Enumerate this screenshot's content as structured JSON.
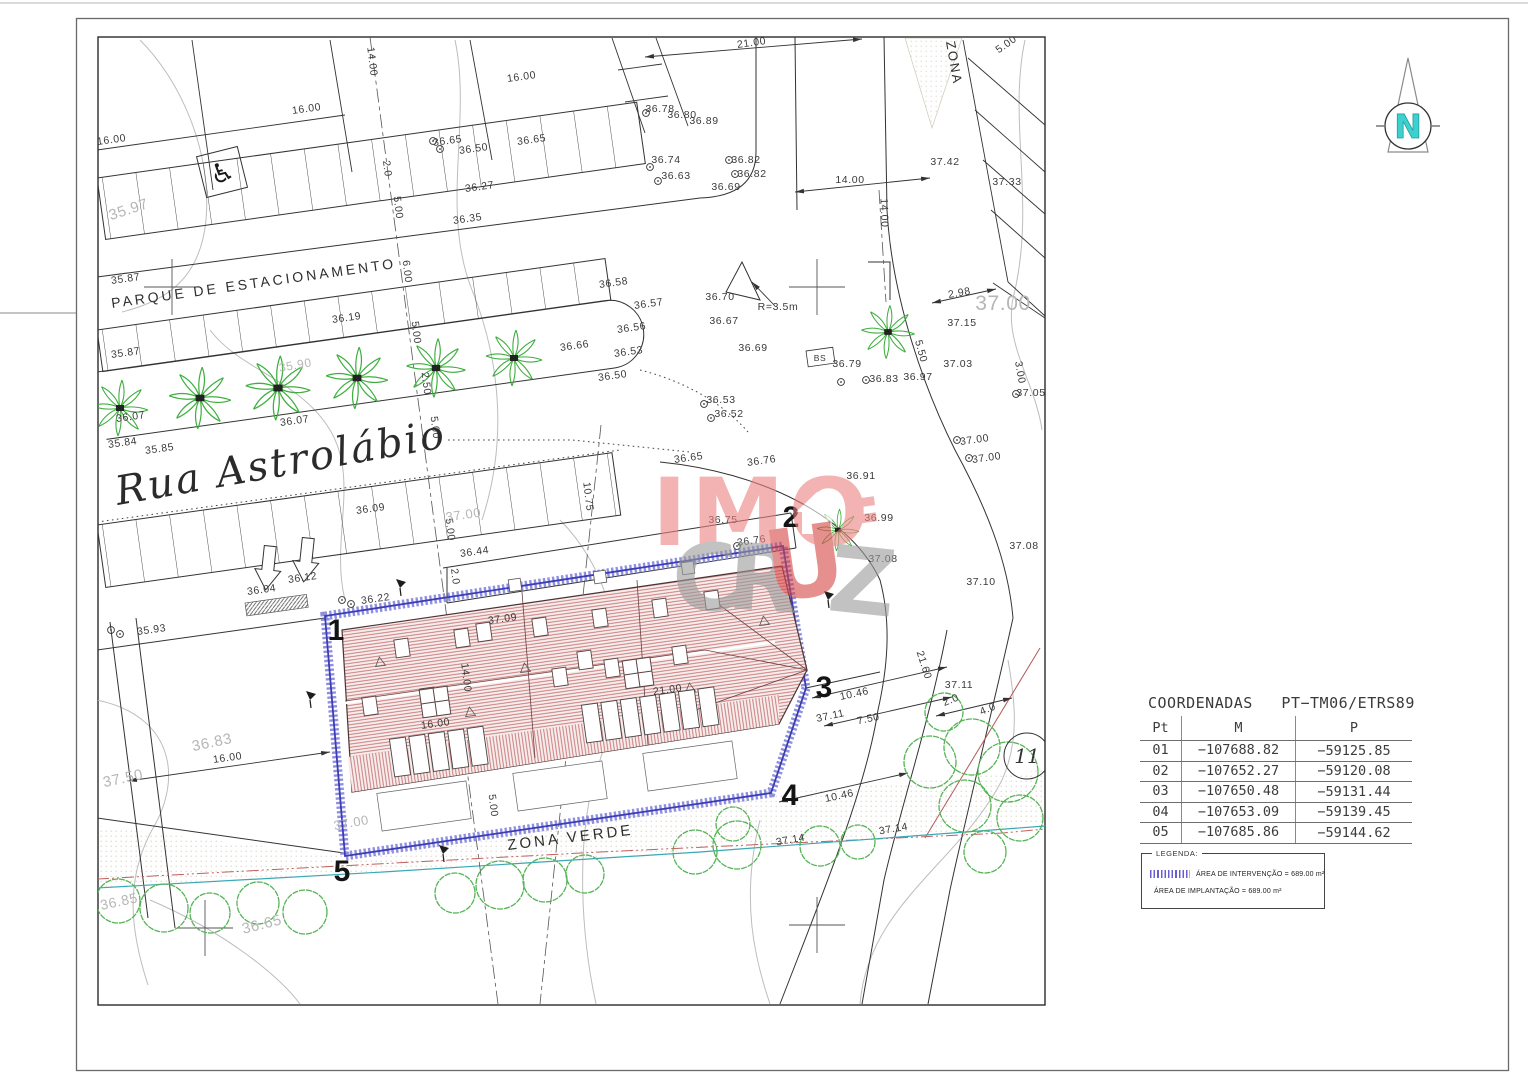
{
  "north": {
    "label": "N"
  },
  "watermark": {
    "top": "IMO",
    "c": "C",
    "r": "R",
    "u": "U",
    "z": "Z"
  },
  "table": {
    "title": "COORDENADAS   PT−TM06/ETRS89",
    "headers": [
      "Pt",
      "M",
      "P"
    ],
    "rows": [
      {
        "pt": "01",
        "m": "−107688.82",
        "p": "−59125.85"
      },
      {
        "pt": "02",
        "m": "−107652.27",
        "p": "−59120.08"
      },
      {
        "pt": "03",
        "m": "−107650.48",
        "p": "−59131.44"
      },
      {
        "pt": "04",
        "m": "−107653.09",
        "p": "−59139.45"
      },
      {
        "pt": "05",
        "m": "−107685.86",
        "p": "−59144.62"
      }
    ]
  },
  "legend": {
    "title": "LEGENDA:",
    "items": [
      {
        "swatch": "intervention-hatch",
        "label": "ÁREA DE INTERVENÇÃO = 689.00 m²"
      },
      {
        "swatch": "none",
        "label": "ÁREA DE IMPLANTAÇÃO = 689.00 m²"
      }
    ]
  },
  "drawing": {
    "street_names": [
      "PARQUE DE ESTACIONAMENTO",
      "Rua Astrolábio",
      "ZONA VERDE",
      "ZONA"
    ],
    "lot_circle": {
      "label": "11",
      "x": 1027,
      "y": 756,
      "r": 23
    },
    "vertices": [
      [
        "1",
        336,
        640
      ],
      [
        "2",
        791,
        527
      ],
      [
        "3",
        824,
        697
      ],
      [
        "4",
        790,
        805
      ],
      [
        "5",
        342,
        881
      ]
    ],
    "labels": [
      [
        "16.00",
        112,
        143,
        -8
      ],
      [
        "16.00",
        307,
        112,
        -8
      ],
      [
        "16.00",
        522,
        80,
        -8
      ],
      [
        "21.00",
        752,
        46,
        -8
      ],
      [
        "14.00",
        369,
        62,
        83
      ],
      [
        "2.0",
        384,
        169,
        83
      ],
      [
        "5.00",
        395,
        208,
        83
      ],
      [
        "6.00",
        404,
        272,
        83
      ],
      [
        "5.00",
        413,
        333,
        83
      ],
      [
        "2.50",
        423,
        384,
        83
      ],
      [
        "5.00",
        432,
        428,
        83
      ],
      [
        "10.75",
        585,
        497,
        83
      ],
      [
        "5.00",
        447,
        530,
        83
      ],
      [
        "2.0",
        452,
        577,
        83
      ],
      [
        "14.00",
        463,
        678,
        83
      ],
      [
        "5.00",
        490,
        806,
        83
      ],
      [
        "16.00",
        436,
        727,
        -8
      ],
      [
        "21.00",
        668,
        693,
        -8
      ],
      [
        "16.00",
        228,
        761,
        -8
      ],
      [
        "14.00",
        850,
        183,
        0
      ],
      [
        "14.00",
        881,
        213,
        88
      ],
      [
        "2.98",
        960,
        296,
        -10
      ],
      [
        "R=3.5m",
        778,
        310,
        0
      ],
      [
        "2.0",
        952,
        703,
        -22
      ],
      [
        "4.0",
        989,
        712,
        -22
      ],
      [
        "21.60",
        921,
        666,
        72
      ],
      [
        "10.46",
        855,
        697,
        -12
      ],
      [
        "7.50",
        869,
        722,
        -12
      ],
      [
        "10.46",
        840,
        799,
        -12
      ],
      [
        "5.50",
        918,
        352,
        75
      ],
      [
        "3.00",
        1017,
        373,
        80
      ],
      [
        "5.00",
        1008,
        47,
        -35
      ],
      [
        "36.27",
        480,
        190,
        -8
      ],
      [
        "36.35",
        468,
        222,
        -8
      ],
      [
        "36.65",
        448,
        144,
        -8
      ],
      [
        "36.50",
        474,
        152,
        -8
      ],
      [
        "36.65",
        532,
        143,
        -8
      ],
      [
        "36.78",
        660,
        112,
        0
      ],
      [
        "36.80",
        682,
        118,
        0
      ],
      [
        "36.89",
        704,
        124,
        0
      ],
      [
        "36.74",
        666,
        163,
        0
      ],
      [
        "36.63",
        676,
        179,
        0
      ],
      [
        "36.82",
        746,
        163,
        0
      ],
      [
        "36.82",
        752,
        177,
        0
      ],
      [
        "36.69",
        726,
        190,
        0
      ],
      [
        "37.42",
        945,
        165,
        0
      ],
      [
        "37.33",
        1007,
        185,
        0
      ],
      [
        "37.05",
        1031,
        396,
        0
      ],
      [
        "36.70",
        720,
        300,
        0
      ],
      [
        "36.67",
        724,
        324,
        0
      ],
      [
        "36.69",
        753,
        351,
        0
      ],
      [
        "36.79",
        847,
        367,
        0
      ],
      [
        "36.83",
        884,
        382,
        0
      ],
      [
        "36.97",
        918,
        380,
        0
      ],
      [
        "37.03",
        958,
        367,
        0
      ],
      [
        "37.15",
        962,
        326,
        0
      ],
      [
        "36.58",
        614,
        286,
        -8
      ],
      [
        "36.57",
        649,
        307,
        -8
      ],
      [
        "36.56",
        632,
        331,
        -8
      ],
      [
        "36.53",
        629,
        355,
        -8
      ],
      [
        "36.50",
        613,
        379,
        -8
      ],
      [
        "36.66",
        575,
        349,
        -8
      ],
      [
        "36.53",
        721,
        403,
        0
      ],
      [
        "36.52",
        729,
        417,
        0
      ],
      [
        "36.19",
        347,
        321,
        -8
      ],
      [
        "36.07",
        131,
        420,
        -8
      ],
      [
        "36.07",
        295,
        424,
        -8
      ],
      [
        "35.84",
        123,
        446,
        -8
      ],
      [
        "35.85",
        160,
        452,
        -8
      ],
      [
        "35.87",
        126,
        282,
        -8
      ],
      [
        "35.87",
        126,
        356,
        -8
      ],
      [
        "36.65",
        689,
        461,
        -8
      ],
      [
        "36.76",
        762,
        464,
        -8
      ],
      [
        "36.91",
        861,
        479,
        0
      ],
      [
        "36.99",
        879,
        521,
        0
      ],
      [
        "37.08",
        883,
        562,
        0
      ],
      [
        "36.75",
        723,
        523,
        0
      ],
      [
        "36.76",
        752,
        544,
        -8
      ],
      [
        "37.00",
        975,
        443,
        -8
      ],
      [
        "37.00",
        987,
        461,
        -8
      ],
      [
        "36.09",
        371,
        512,
        -8
      ],
      [
        "36.44",
        475,
        555,
        -8
      ],
      [
        "36.12",
        303,
        581,
        -8
      ],
      [
        "36.04",
        262,
        593,
        -8
      ],
      [
        "36.22",
        376,
        602,
        -8
      ],
      [
        "35.93",
        152,
        633,
        -8
      ],
      [
        "37.09",
        503,
        622,
        -8
      ],
      [
        "37.10",
        981,
        585,
        0
      ],
      [
        "37.08",
        1024,
        549,
        0
      ],
      [
        "37.11",
        959,
        688,
        0
      ],
      [
        "37.11",
        831,
        719,
        -12
      ],
      [
        "37.14",
        894,
        832,
        -10
      ],
      [
        "37.14",
        791,
        843,
        -10
      ],
      [
        "BS",
        820,
        361,
        0,
        8.5
      ],
      [
        "35.97",
        130,
        214,
        -18,
        15,
        "g"
      ],
      [
        "35.90",
        296,
        369,
        -10,
        12,
        "g"
      ],
      [
        "37.00",
        464,
        519,
        -8,
        13,
        "g"
      ],
      [
        "36.83",
        213,
        747,
        -12,
        15,
        "g"
      ],
      [
        "37.50",
        124,
        783,
        -12,
        15,
        "g"
      ],
      [
        "37.00",
        352,
        827,
        -10,
        13,
        "g"
      ],
      [
        "36.65",
        263,
        929,
        -14,
        15,
        "g"
      ],
      [
        "36.85",
        120,
        906,
        -12,
        14,
        "g"
      ],
      [
        "37.00",
        1003,
        310,
        0,
        21,
        "g"
      ],
      [
        "PARQUE DE ESTACIONAMENTO",
        112,
        308,
        -8,
        14,
        "k",
        "street"
      ],
      [
        "Rua Astrolábio",
        118,
        505,
        -10,
        40,
        "k",
        "rua"
      ],
      [
        "ZONA VERDE",
        508,
        850,
        -7,
        15,
        "k",
        "street"
      ],
      [
        "ZONA",
        946,
        42,
        80,
        13,
        "k",
        "street2"
      ]
    ],
    "markers": [
      [
        646,
        113
      ],
      [
        650,
        167
      ],
      [
        658,
        181
      ],
      [
        729,
        160
      ],
      [
        735,
        174
      ],
      [
        704,
        404
      ],
      [
        711,
        418
      ],
      [
        433,
        141
      ],
      [
        440,
        149
      ],
      [
        342,
        600
      ],
      [
        351,
        604
      ],
      [
        111,
        630
      ],
      [
        120,
        634
      ],
      [
        957,
        440
      ],
      [
        969,
        458
      ],
      [
        737,
        546
      ],
      [
        1016,
        394
      ],
      [
        866,
        380
      ],
      [
        841,
        382
      ]
    ],
    "trees": [
      [
        118,
        901,
        22
      ],
      [
        164,
        908,
        24
      ],
      [
        210,
        913,
        20
      ],
      [
        258,
        903,
        21
      ],
      [
        305,
        912,
        22
      ],
      [
        455,
        893,
        20
      ],
      [
        500,
        885,
        24
      ],
      [
        545,
        880,
        22
      ],
      [
        585,
        874,
        19
      ],
      [
        695,
        852,
        22
      ],
      [
        737,
        845,
        24
      ],
      [
        820,
        846,
        20
      ],
      [
        858,
        842,
        17
      ],
      [
        930,
        762,
        26
      ],
      [
        972,
        747,
        28
      ],
      [
        1008,
        772,
        30
      ],
      [
        965,
        806,
        26
      ],
      [
        1020,
        818,
        23
      ],
      [
        985,
        852,
        21
      ],
      [
        944,
        712,
        19
      ],
      [
        733,
        824,
        17
      ]
    ],
    "palms": [
      [
        120,
        408,
        1
      ],
      [
        200,
        398,
        1.1
      ],
      [
        278,
        388,
        1.15
      ],
      [
        357,
        378,
        1.1
      ],
      [
        436,
        368,
        1.05
      ],
      [
        514,
        358,
        1
      ],
      [
        888,
        332,
        0.95
      ],
      [
        838,
        530,
        0.75
      ]
    ],
    "windows": [
      [
        402,
        648
      ],
      [
        462,
        638
      ],
      [
        540,
        627
      ],
      [
        600,
        618
      ],
      [
        660,
        608
      ],
      [
        712,
        600
      ],
      [
        370,
        706
      ],
      [
        428,
        697
      ],
      [
        560,
        677
      ],
      [
        612,
        668
      ],
      [
        680,
        655
      ],
      [
        484,
        632
      ],
      [
        585,
        660
      ]
    ],
    "window_grids": [
      [
        435,
        702
      ],
      [
        638,
        673
      ]
    ],
    "roof_squares": [
      [
        515,
        585
      ],
      [
        600,
        577
      ],
      [
        688,
        568
      ]
    ],
    "roof_triangles": [
      [
        380,
        662
      ],
      [
        525,
        668
      ],
      [
        470,
        712
      ],
      [
        690,
        688
      ],
      [
        764,
        621
      ]
    ],
    "garages": [
      {
        "x": 400,
        "y": 757,
        "n": 5
      },
      {
        "x": 592,
        "y": 723,
        "n": 7
      }
    ],
    "terraces": [
      [
        424,
        806
      ],
      [
        560,
        786
      ],
      [
        690,
        766
      ]
    ],
    "utilities": [
      [
        400,
        588
      ],
      [
        828,
        600
      ],
      [
        310,
        700
      ],
      [
        443,
        854
      ]
    ]
  }
}
